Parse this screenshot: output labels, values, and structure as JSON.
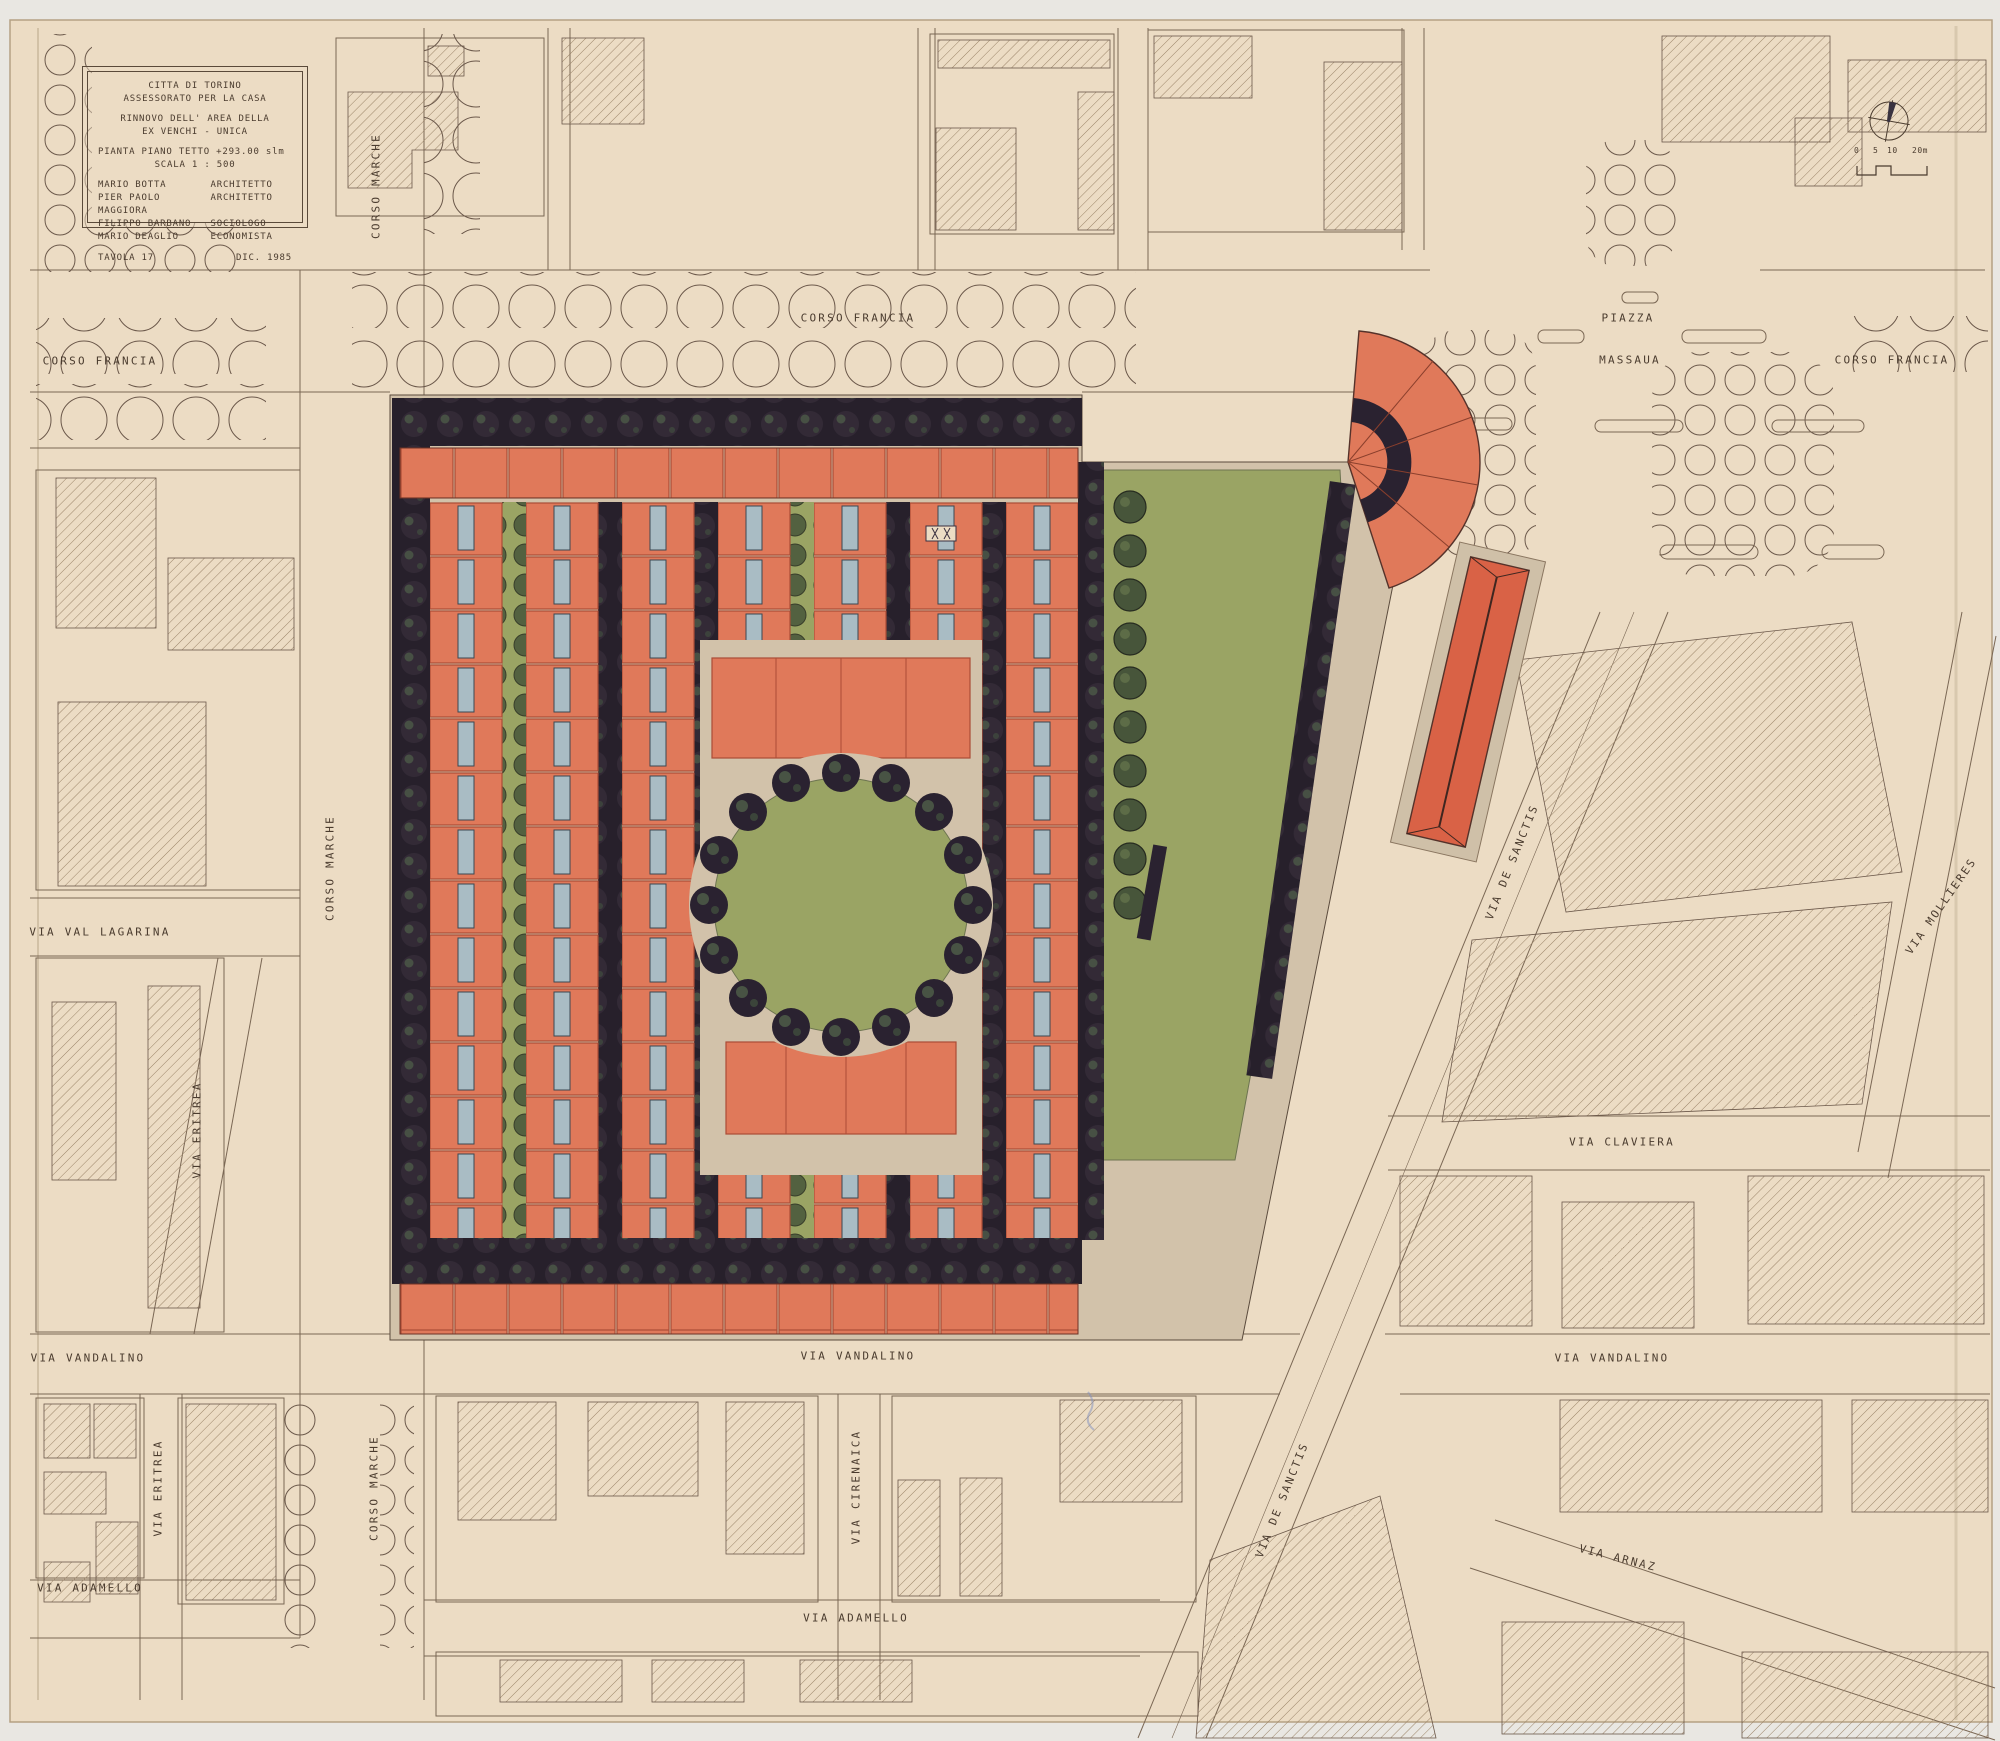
{
  "title_block": {
    "org_line1": "CITTA  DI  TORINO",
    "org_line2": "ASSESSORATO PER LA CASA",
    "project_line1": "RINNOVO  DELL' AREA  DELLA",
    "project_line2": "EX VENCHI - UNICA",
    "drawing_line1": "PIANTA  PIANO  TETTO  +293.00 slm",
    "drawing_line2": "SCALA       1 : 500",
    "credits": [
      {
        "name": "MARIO  BOTTA",
        "role": "ARCHITETTO"
      },
      {
        "name": "PIER PAOLO MAGGIORA",
        "role": "ARCHITETTO"
      },
      {
        "name": "FILIPPO  BARBANO",
        "role": "SOCIOLOGO"
      },
      {
        "name": "MARIO  DEAGLIO",
        "role": "ECONOMISTA"
      }
    ],
    "sheet_no": "TAVOLA  17",
    "date": "DIC.    1985"
  },
  "scale_bar": {
    "tick0": "0",
    "tick5": "5",
    "tick10": "10",
    "tick20": "20m"
  },
  "streets": {
    "corso_francia": "CORSO  FRANCIA",
    "corso_marche": "CORSO  MARCHE",
    "piazza": "PIAZZA",
    "massaua": "MASSAUA",
    "via_val_lagarina": "VIA VAL  LAGARINA",
    "via_eritrea": "VIA  ERITREA",
    "via_vandalino": "VIA  VANDALINO",
    "via_adamello": "VIA  ADAMELLO",
    "via_cirenaica": "VIA  CIRENAICA",
    "via_de_sanctis": "VIA  DE  SANCTIS",
    "via_claviera": "VIA  CLAVIERA",
    "via_mollieres": "VIA  MOLLIERES",
    "via_arnaz": "VIA  ARNAZ"
  },
  "colors": {
    "paper": "#ecdcc4",
    "building_orange": "#e0795a",
    "gable_red": "#d96246",
    "lawn_green": "#9aa464",
    "tree_dark": "#2c2430",
    "tree_green": "#47553a",
    "roof_blue": "#a9bcc4",
    "ink_line": "#6b584a"
  }
}
